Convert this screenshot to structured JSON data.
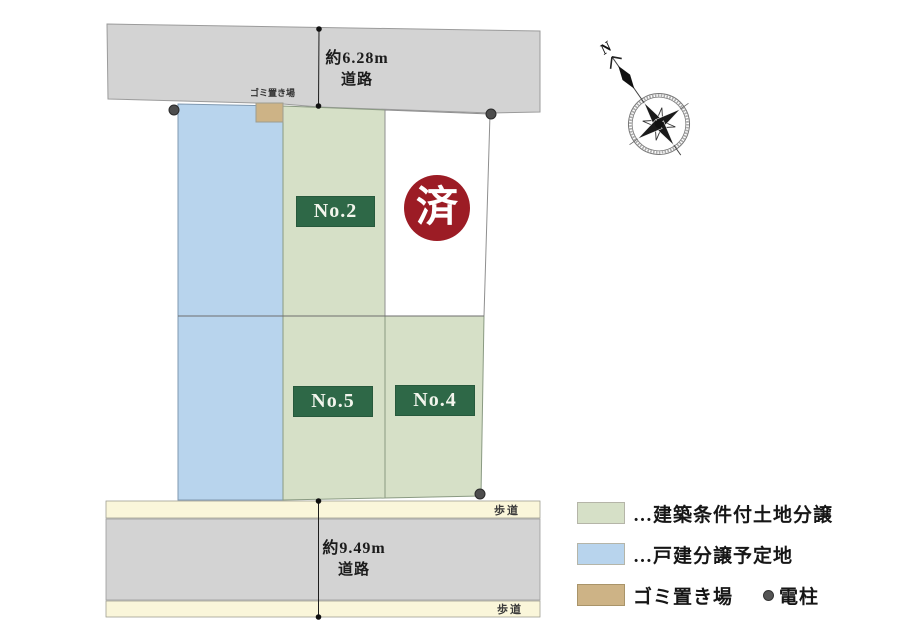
{
  "map": {
    "top_road": {
      "line1": "約6.28m",
      "line2": "道路"
    },
    "bottom_road": {
      "line1": "約9.49m",
      "line2": "道路"
    },
    "sidewalk_label": "歩道",
    "garbage_site_label": "ゴミ置き場",
    "lots": {
      "no2": "No.2",
      "no5": "No.5",
      "no4": "No.4",
      "sold": "済"
    },
    "compass": {
      "north": "N"
    }
  },
  "legend": {
    "items": [
      {
        "key": "green",
        "label": "…建築条件付土地分譲",
        "color": "#d6e0c7"
      },
      {
        "key": "blue",
        "label": "…戸建分譲予定地",
        "color": "#b8d4ed"
      },
      {
        "key": "tan",
        "label": "ゴミ置き場",
        "color": "#cdb386"
      }
    ],
    "pole_label": "電柱"
  },
  "colors": {
    "road_gray": "#d3d3d3",
    "sidewalk_cream": "#faf6da",
    "lot_green": "#d6e0c7",
    "lot_blue": "#b8d4ed",
    "garbage_tan": "#cdb386",
    "lot_tag_green": "#2e6847",
    "sold_red": "#9c1c25"
  }
}
